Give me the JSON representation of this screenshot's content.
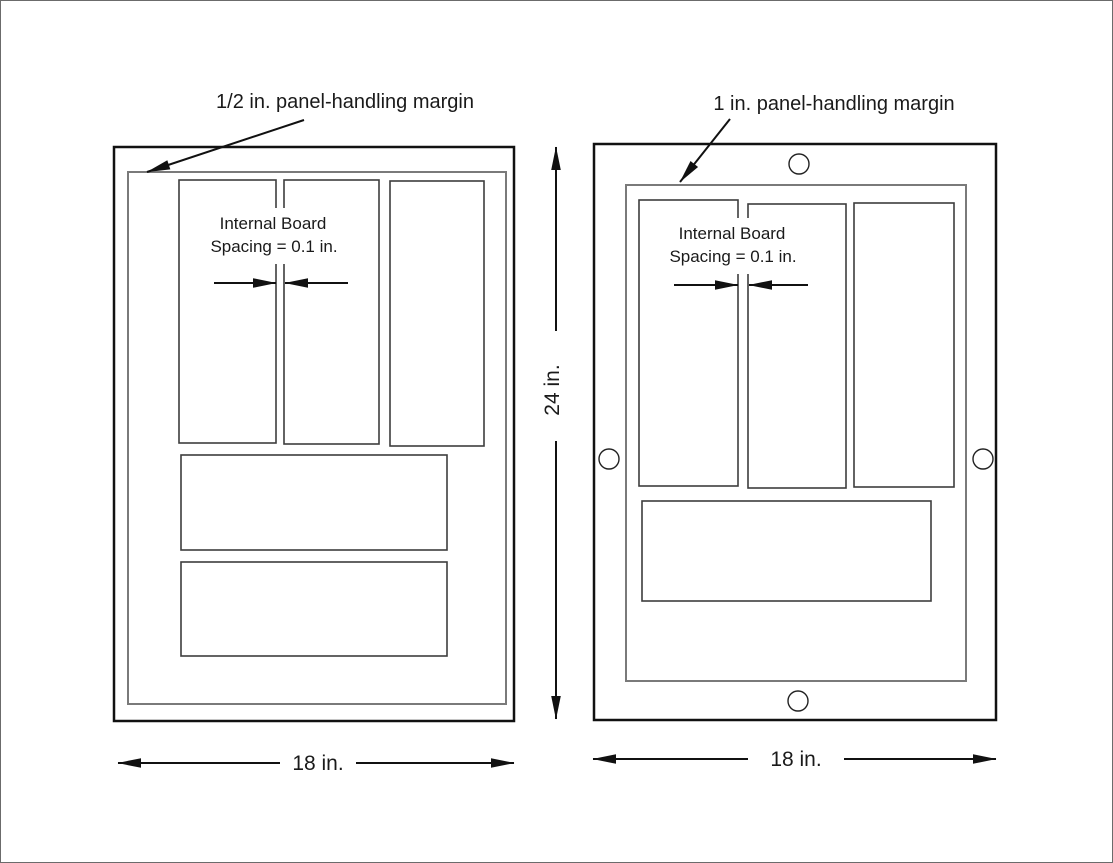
{
  "canvas": {
    "background": "#ffffff",
    "outline_color": "#111111",
    "board_outline_color": "#3d3d3d",
    "margin_outline_color": "#7a7a7a",
    "text_color": "#1a1a1a"
  },
  "panels": {
    "left": {
      "margin_callout": "1/2 in. panel-handling margin",
      "internal_spacing": {
        "line1": "Internal Board",
        "line2": "Spacing = 0.1 in."
      },
      "width_dim": "18 in.",
      "board_count_tall": 3,
      "board_count_wide": 2
    },
    "right": {
      "margin_callout": "1 in. panel-handling margin",
      "internal_spacing": {
        "line1": "Internal Board",
        "line2": "Spacing = 0.1 in."
      },
      "width_dim": "18 in.",
      "board_count_tall": 3,
      "board_count_wide": 1,
      "tooling_holes": 4
    }
  },
  "shared": {
    "height_dim": "24 in."
  }
}
